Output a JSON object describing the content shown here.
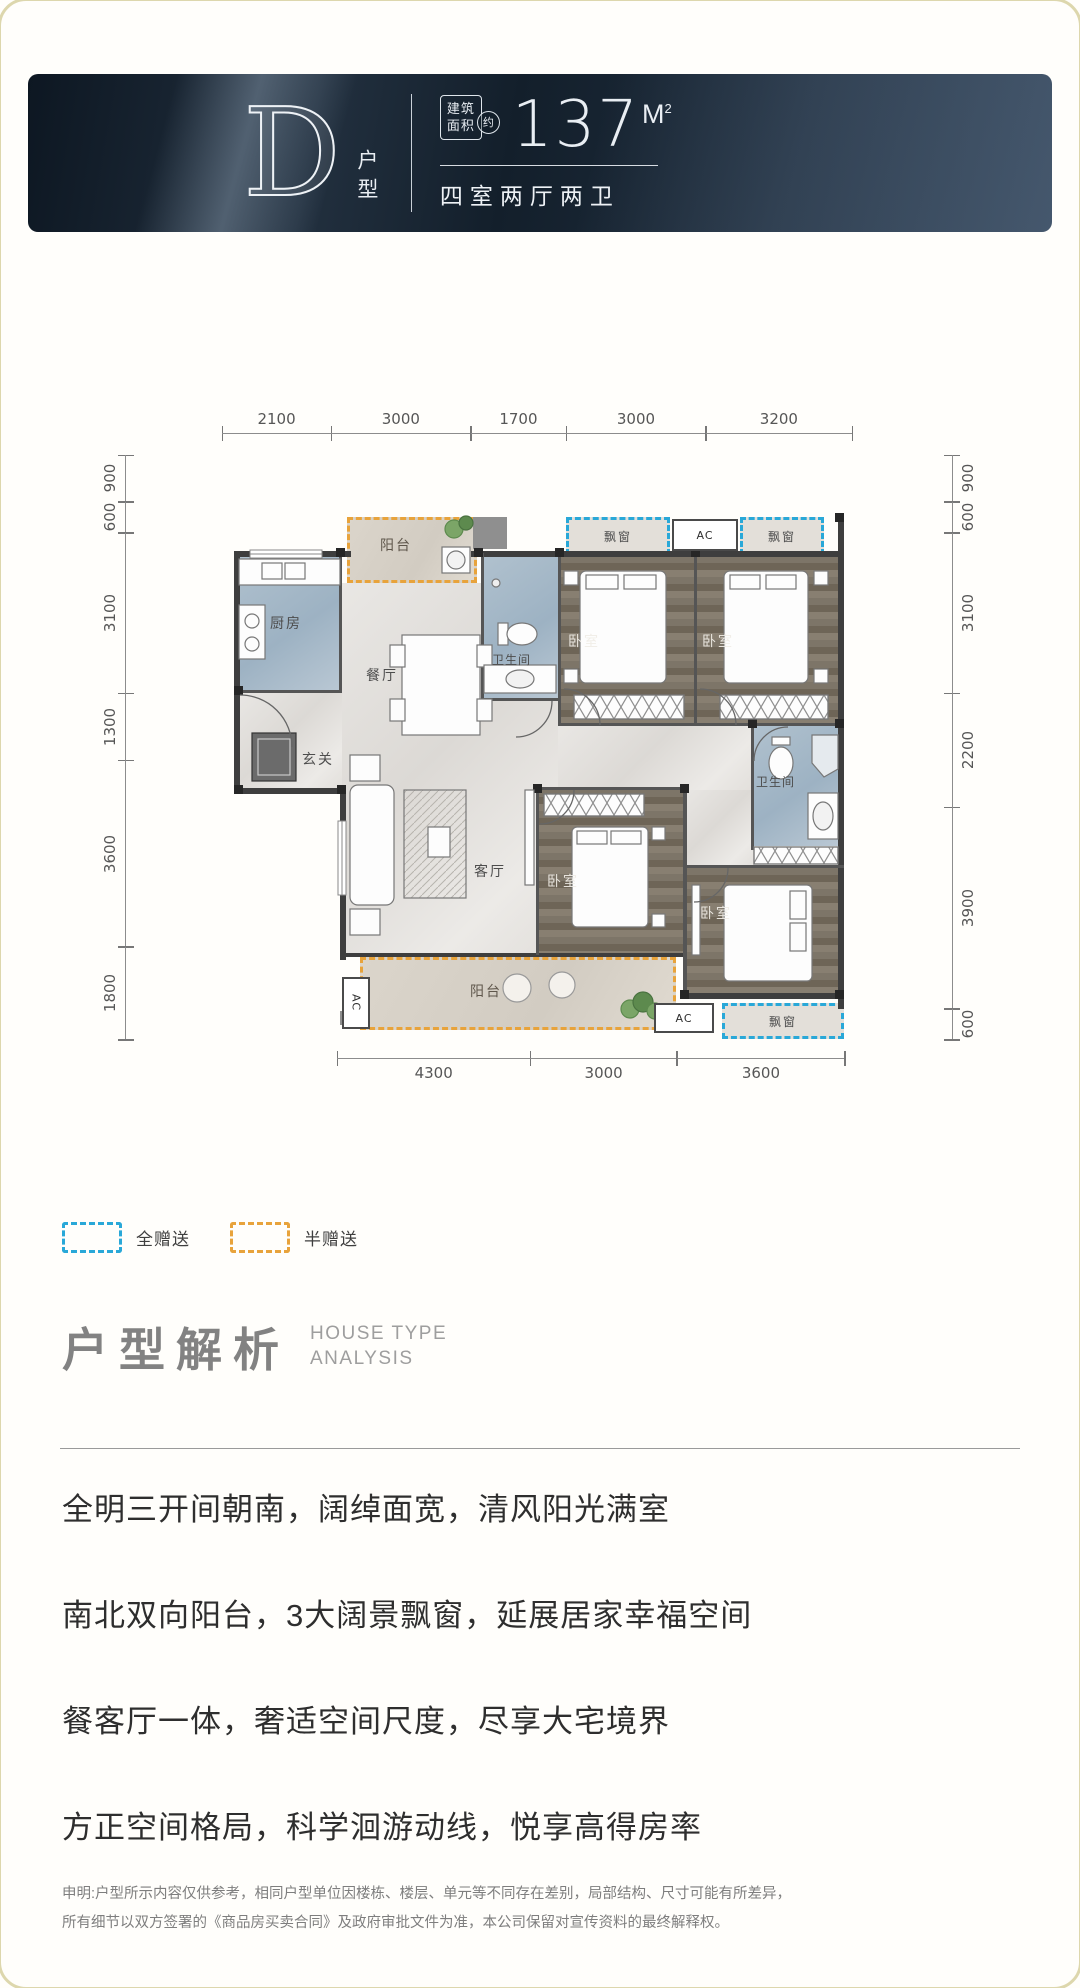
{
  "banner": {
    "unit_letter": "D",
    "unit_label": "户型",
    "area_box_line1": "建筑",
    "area_box_line2": "面积",
    "approx": "约",
    "area_value": "137",
    "area_unit": "M",
    "area_sup": "2",
    "layout_desc": "四室两厅两卫",
    "background_color": "#1b2938"
  },
  "plan": {
    "dims_top": [
      "2100",
      "3000",
      "1700",
      "3000",
      "3200"
    ],
    "dims_left": [
      "900",
      "600",
      "3100",
      "1300",
      "3600",
      "1800"
    ],
    "dims_right": [
      "900",
      "600",
      "3100",
      "2200",
      "3900",
      "600"
    ],
    "dims_bottom": [
      "4300",
      "3000",
      "3600"
    ],
    "rooms": {
      "balcony": "阳台",
      "kitchen": "厨房",
      "dining": "餐厅",
      "bathroom": "卫生间",
      "bedroom": "卧室",
      "entry": "玄关",
      "living": "客厅",
      "bay_window": "飘窗",
      "ac": "AC"
    }
  },
  "legend": {
    "full_gift": "全赠送",
    "full_gift_color": "#29a8d8",
    "half_gift": "半赠送",
    "half_gift_color": "#e8a33b"
  },
  "analysis": {
    "title": "户型解析",
    "subtitle_line1": "HOUSE TYPE",
    "subtitle_line2": "ANALYSIS",
    "points": [
      "全明三开间朝南，阔绰面宽，清风阳光满室",
      "南北双向阳台，3大阔景飘窗，延展居家幸福空间",
      "餐客厅一体，奢适空间尺度，尽享大宅境界",
      "方正空间格局，科学洄游动线，悦享高得房率"
    ]
  },
  "disclaimer": {
    "line1": "申明:户型所示内容仅供参考，相同户型单位因楼栋、楼层、单元等不同存在差别，局部结构、尺寸可能有所差异，",
    "line2": "所有细节以双方签署的《商品房买卖合同》及政府审批文件为准，本公司保留对宣传资料的最终解释权。"
  }
}
